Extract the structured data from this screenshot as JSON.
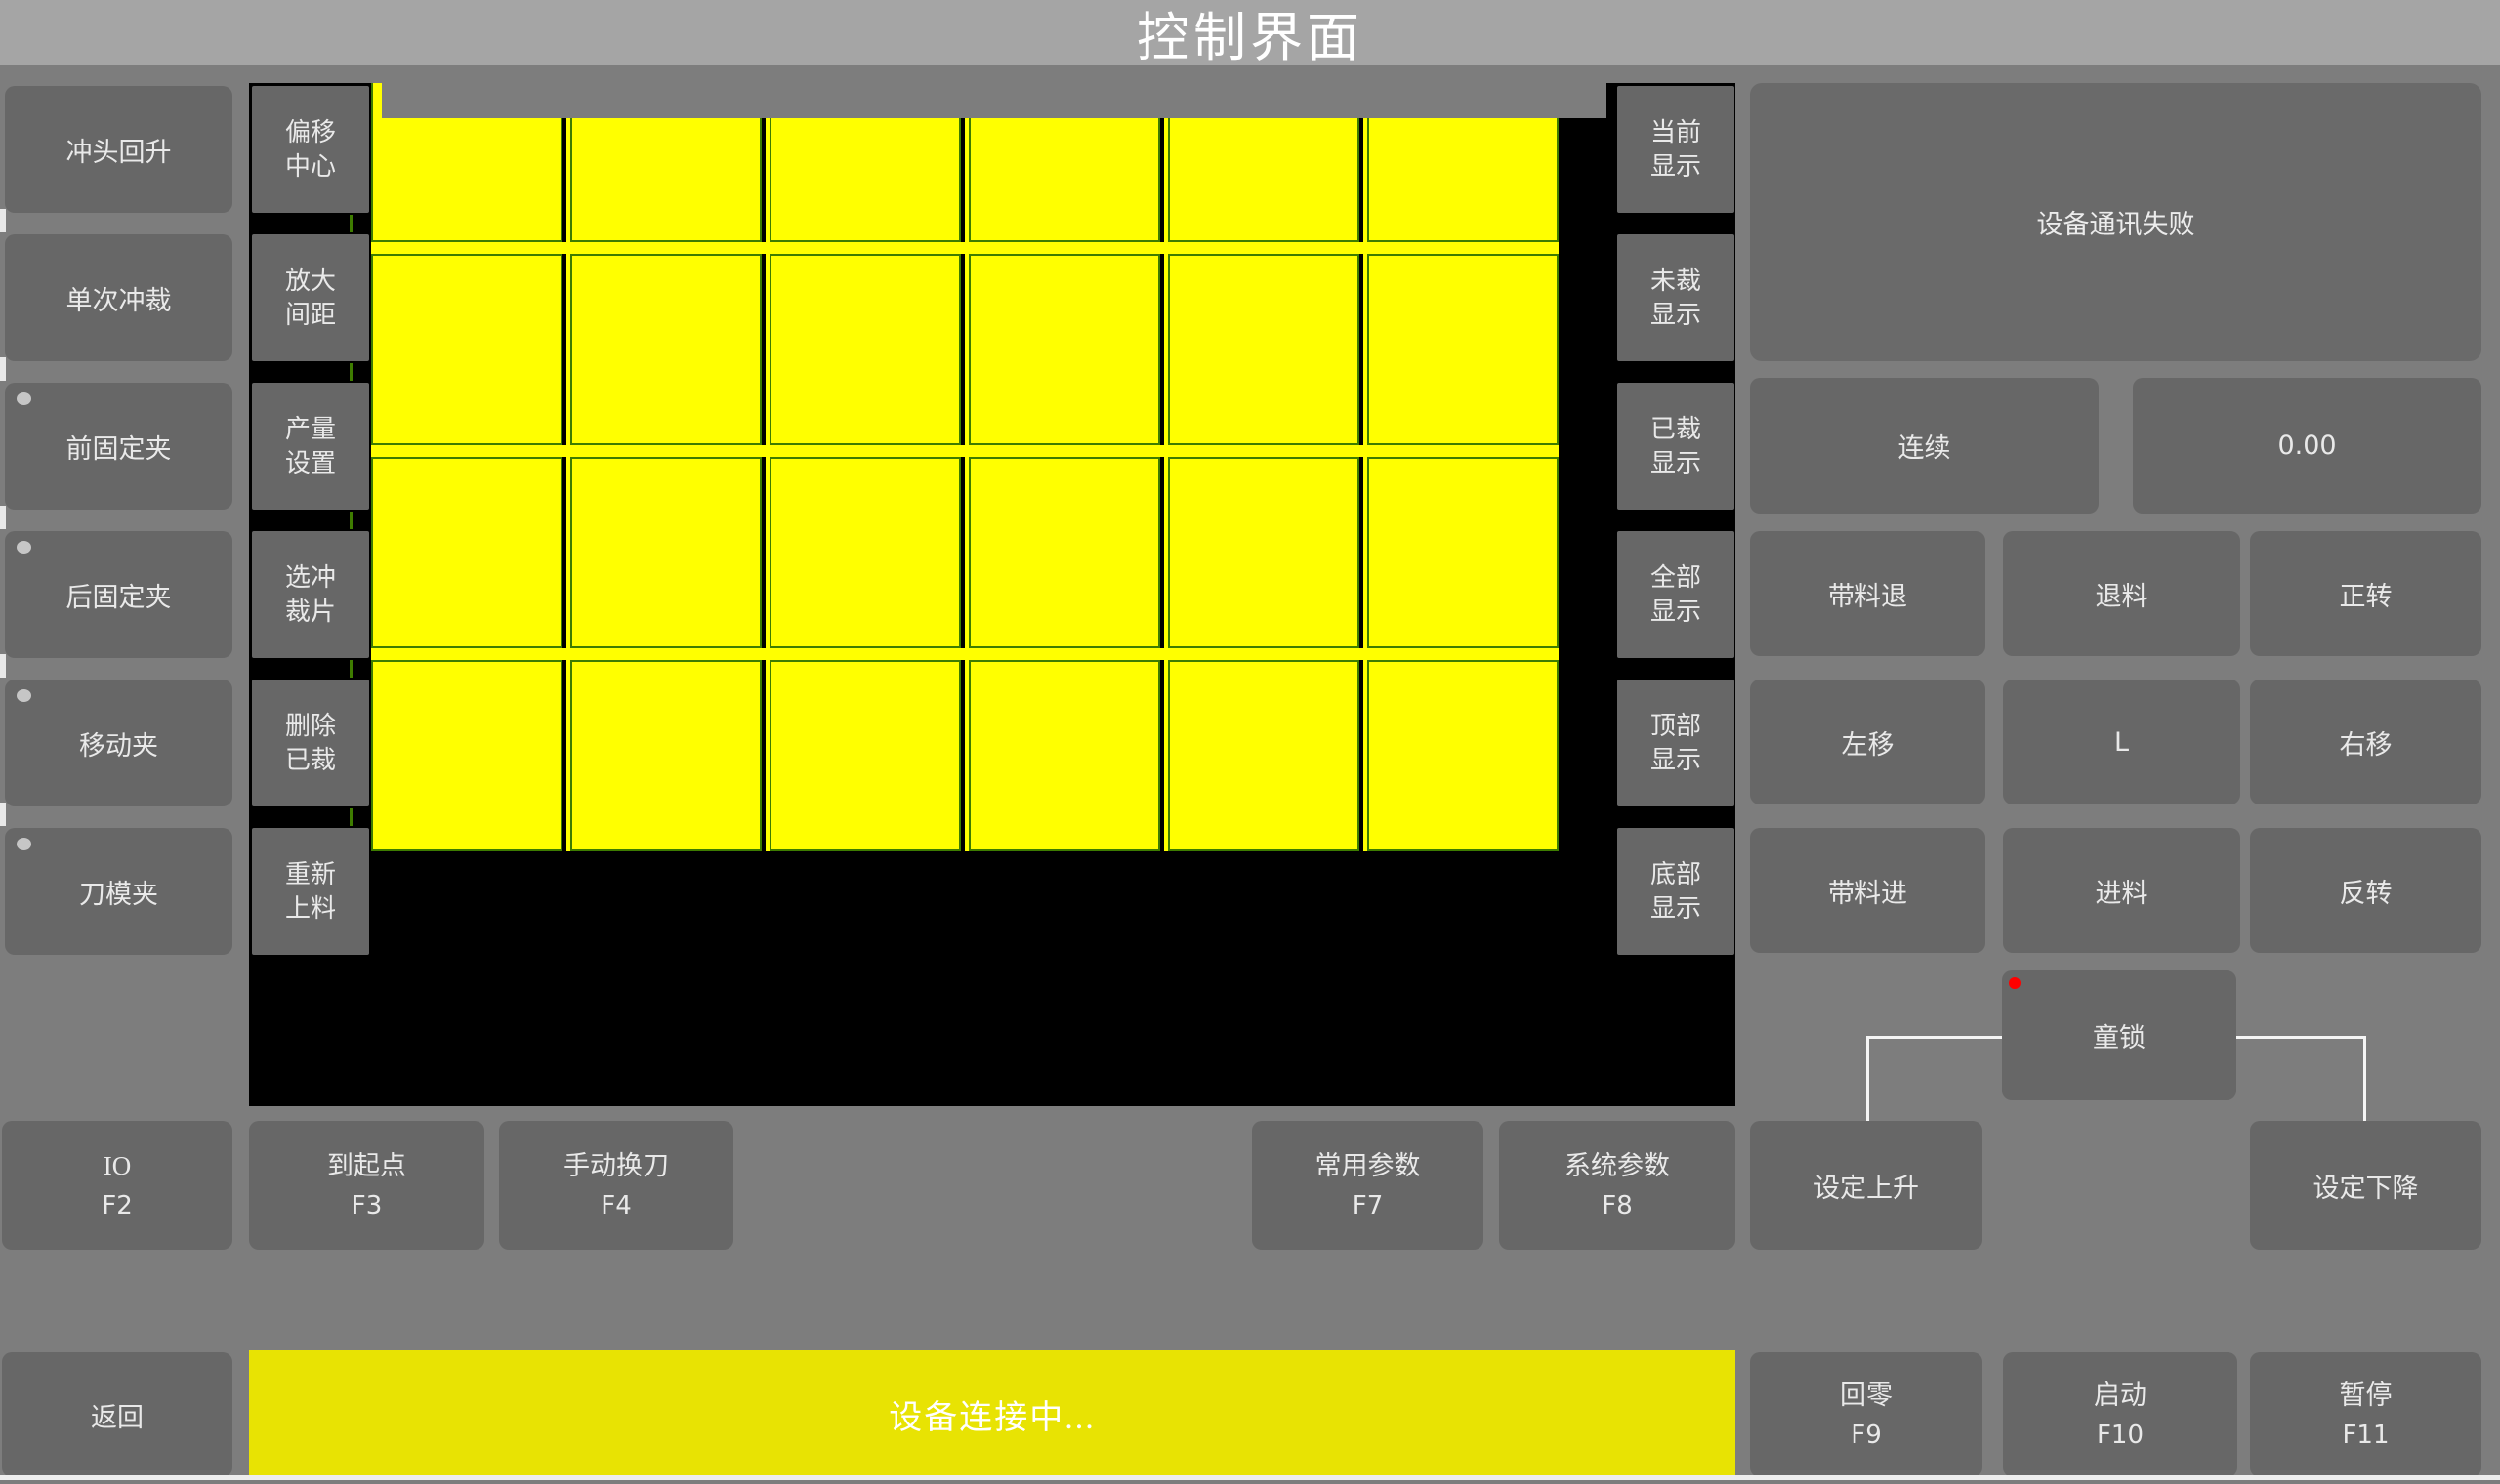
{
  "title": "控制界面",
  "left_nav": {
    "items": [
      {
        "label": "冲头回升",
        "dot": false
      },
      {
        "label": "单次冲裁",
        "dot": false
      },
      {
        "label": "前固定夹",
        "dot": true
      },
      {
        "label": "后固定夹",
        "dot": true
      },
      {
        "label": "移动夹",
        "dot": true
      },
      {
        "label": "刀模夹",
        "dot": true
      }
    ]
  },
  "tool_column": {
    "items": [
      "偏移\n中心",
      "放大\n间距",
      "产量\n设置",
      "选冲\n裁片",
      "删除\n已裁",
      "重新\n上料"
    ]
  },
  "display_column": {
    "items": [
      "当前\n显示",
      "未裁\n显示",
      "已裁\n显示",
      "全部\n显示",
      "顶部\n显示",
      "底部\n显示"
    ]
  },
  "preview": {
    "rows": 4,
    "cols": 6,
    "piece_color": "#ffff00",
    "piece_border": "#3e7c00",
    "cut_line": "#000000",
    "background": "#000000"
  },
  "right_panel": {
    "message": "设备通讯失败",
    "mode_button": "连续",
    "value": "0.00",
    "jog_grid": [
      "带料退",
      "退料",
      "正转",
      "左移",
      "L",
      "右移",
      "带料进",
      "进料",
      "反转"
    ],
    "child_lock": "童锁",
    "set_up": "设定上升",
    "set_down": "设定下降"
  },
  "function_row": [
    {
      "label": "IO",
      "key": "F2"
    },
    {
      "label": "到起点",
      "key": "F3"
    },
    {
      "label": "手动换刀",
      "key": "F4"
    },
    {
      "label": "常用参数",
      "key": "F7"
    },
    {
      "label": "系统参数",
      "key": "F8"
    }
  ],
  "bottom_bar": {
    "back": "返回",
    "status": "设备连接中...",
    "actions": [
      {
        "label": "回零",
        "key": "F9"
      },
      {
        "label": "启动",
        "key": "F10"
      },
      {
        "label": "暂停",
        "key": "F11"
      }
    ]
  },
  "colors": {
    "status_yellow": "#e8e303",
    "piece_yellow": "#ffff00",
    "alert_red": "#ff0000",
    "titlebar_gray": "#a5a5a5"
  }
}
